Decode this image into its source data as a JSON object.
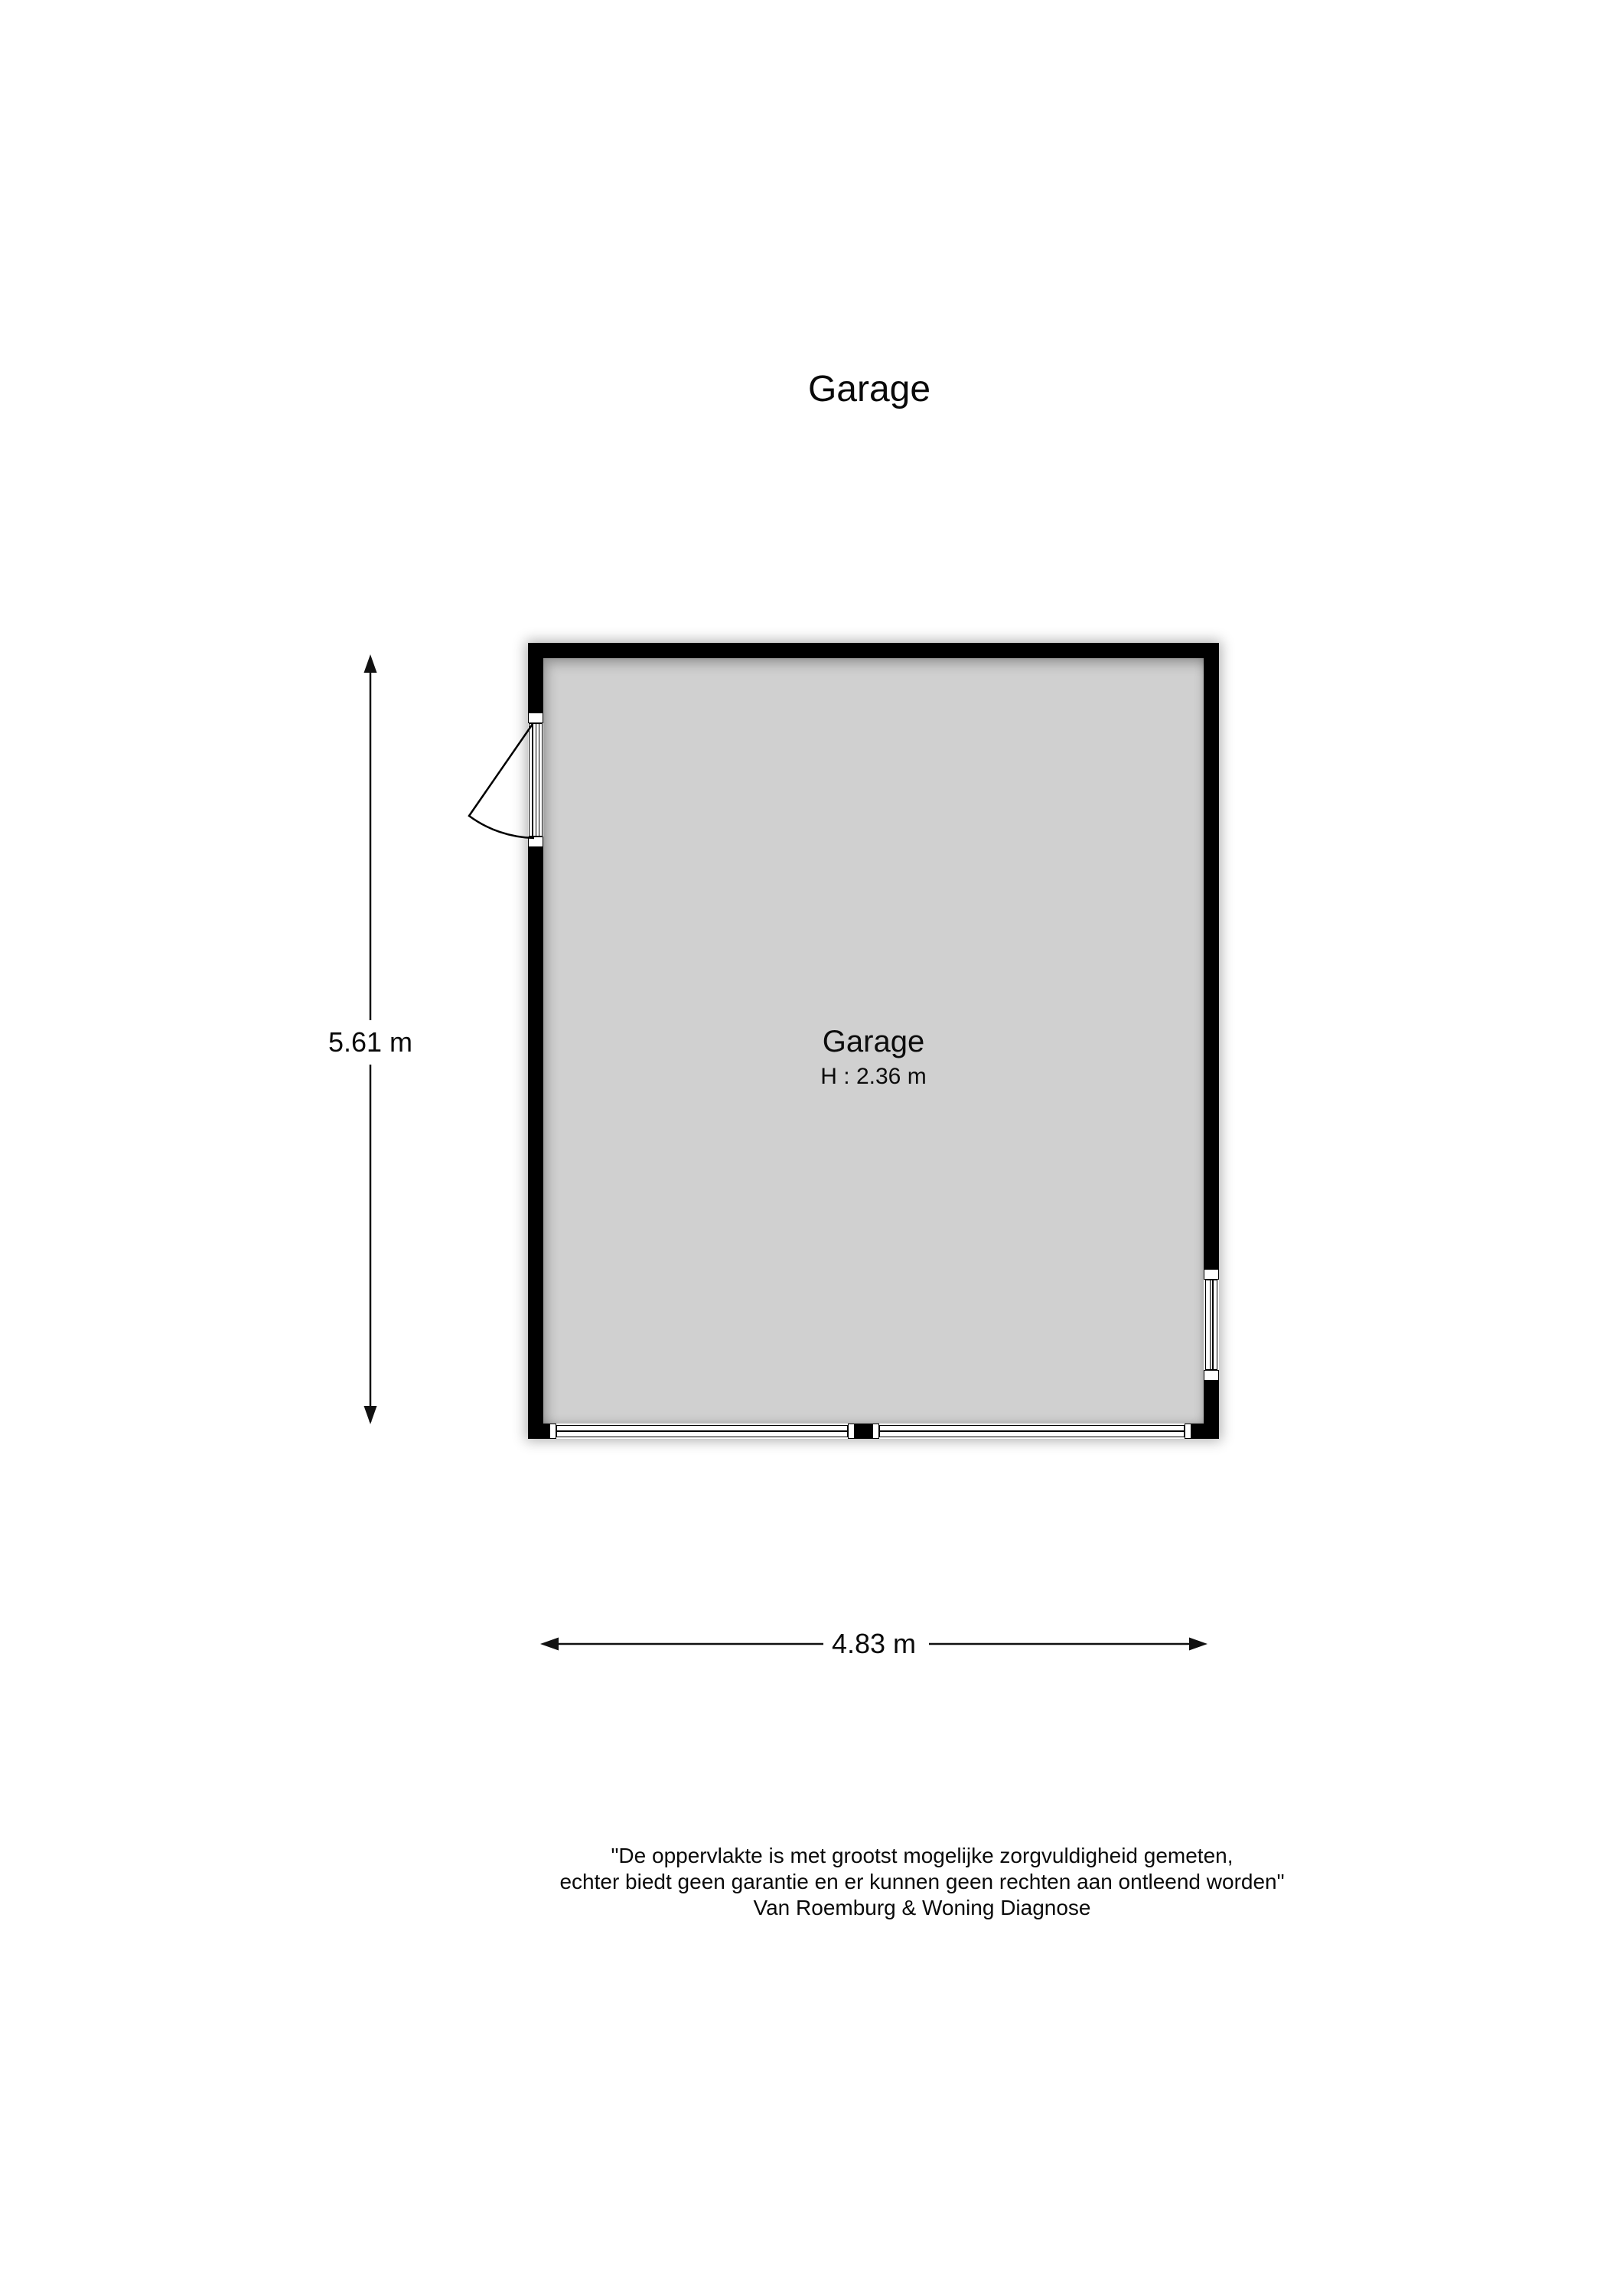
{
  "page": {
    "title": "Garage"
  },
  "plan": {
    "room": {
      "name": "Garage",
      "ceiling_height": "H : 2.36 m"
    },
    "dimensions": {
      "height": "5.61 m",
      "width": "4.83 m"
    }
  },
  "disclaimer": {
    "line1": "\"De oppervlakte is met grootst mogelijke zorgvuldigheid gemeten,",
    "line2": "echter biedt geen garantie en er kunnen geen rechten aan ontleend worden\"",
    "line3": "Van Roemburg & Woning Diagnose"
  },
  "colors": {
    "wall": "#000000",
    "floor": "#d0d0d0",
    "line": "#1a1a1a",
    "background": "#ffffff"
  }
}
